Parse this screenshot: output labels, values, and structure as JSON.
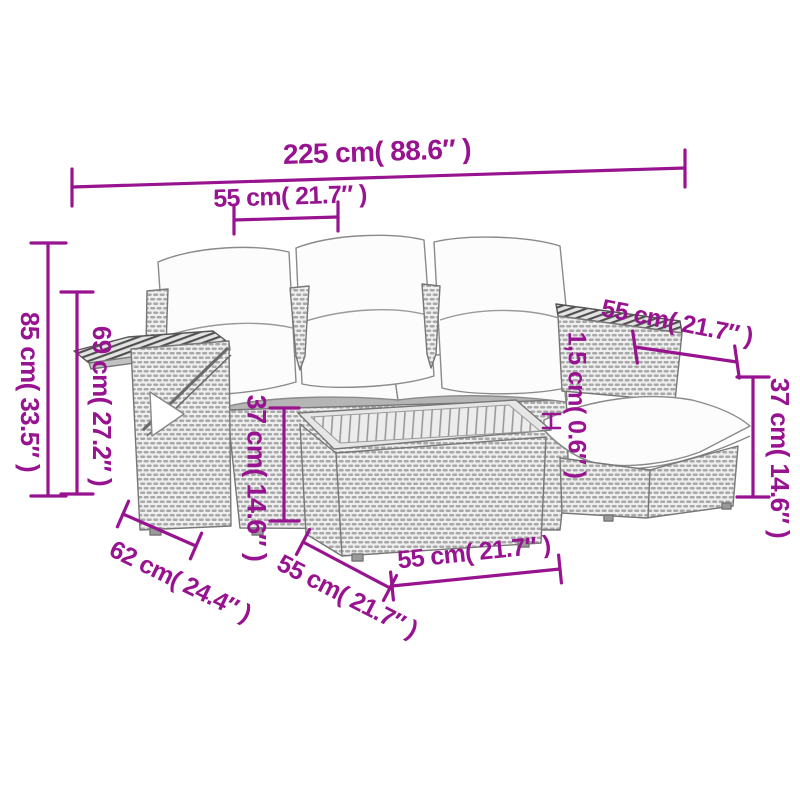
{
  "diagram": {
    "subject": "garden-lounge-set-dimension-diagram",
    "accent_color": "#981390",
    "furniture_outline_color": "#777777"
  },
  "dimensions": {
    "overall_width": "225 cm( 88.6″ )",
    "seat_width": "55 cm( 21.7″ )",
    "overall_height": "85 cm( 33.5″ )",
    "armrest_height": "69 cm( 27.2″ )",
    "seat_height": "37 cm( 14.6″ )",
    "cushion_thickness": "1,5 cm( 0.6″ )",
    "stool_width": "55 cm( 21.7″ )",
    "stool_height": "37 cm( 14.6″ )",
    "sofa_depth": "62 cm( 24.4″ )",
    "table_depth": "55 cm( 21.7″ )",
    "table_width": "55 cm( 21.7″ )"
  }
}
